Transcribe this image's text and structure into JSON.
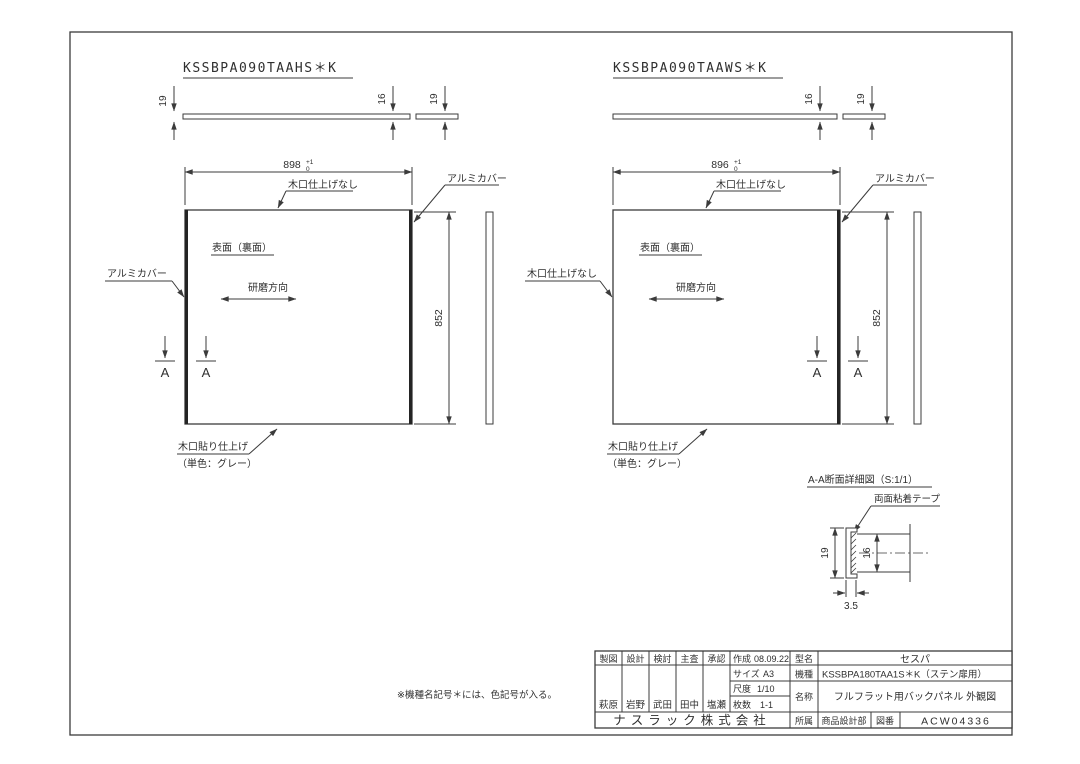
{
  "panels": [
    {
      "code": "KSSBPA090TAAHS＊K",
      "width": "898",
      "width_tol_plus": "+1",
      "width_tol_minus": "0",
      "height": "852",
      "thickness": "16",
      "cover_left": "19",
      "cover_right": "19",
      "top_edge_label": "木口仕上げなし",
      "right_cover_label": "アルミカバー",
      "left_edge_label": "アルミカバー",
      "surface_label": "表面（裏面）",
      "polish_label": "研磨方向",
      "bottom_edge_label1": "木口貼り仕上げ",
      "bottom_edge_label2": "（単色：グレー）",
      "section_letter": "A"
    },
    {
      "code": "KSSBPA090TAAWS＊K",
      "width": "896",
      "width_tol_plus": "+1",
      "width_tol_minus": "0",
      "height": "852",
      "thickness": "16",
      "cover_right": "19",
      "top_edge_label": "木口仕上げなし",
      "right_cover_label": "アルミカバー",
      "left_edge_label": "木口仕上げなし",
      "surface_label": "表面（裏面）",
      "polish_label": "研磨方向",
      "bottom_edge_label1": "木口貼り仕上げ",
      "bottom_edge_label2": "（単色：グレー）",
      "section_letter": "A"
    }
  ],
  "section_detail": {
    "title": "A-A断面詳細図（S:1/1）",
    "tape_label": "両面粘着テープ",
    "dim_height": "19",
    "dim_panel": "16",
    "dim_depth": "3.5"
  },
  "note": "※機種名記号＊には、色記号が入る。",
  "title_block": {
    "sign_headers": [
      "製図",
      "設計",
      "検討",
      "主査",
      "承認"
    ],
    "sign_names": [
      "萩原",
      "岩野",
      "武田",
      "田中",
      "塩瀬"
    ],
    "created_label": "作成",
    "created_value": "08.09.22",
    "size_label": "サイズ",
    "size_value": "A3",
    "scale_label": "尺度",
    "scale_value": "1/10",
    "sheets_label": "枚数",
    "sheets_value": "1-1",
    "model_label": "型名",
    "model_value": "セスパ",
    "machine_label": "機種",
    "machine_value": "KSSBPA180TAA1S＊K（ステン扉用）",
    "title_label": "名称",
    "title_value": "フルフラット用バックパネル 外観図",
    "company": "ナスラック株式会社",
    "dept_label": "所属",
    "dept_value": "商品設計部",
    "drawing_no_label": "図番",
    "drawing_no_value": "ACW04336"
  }
}
